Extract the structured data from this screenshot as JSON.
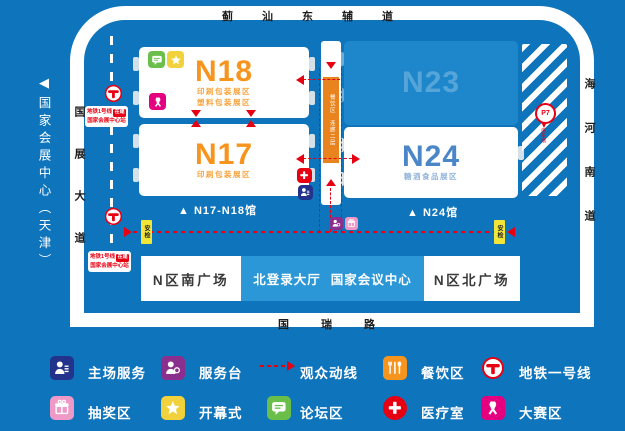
{
  "map": {
    "venue": {
      "arrow": "◀",
      "name": "国家会展中心（天津）"
    },
    "roads": {
      "top": "蓟汕东辅道",
      "left": "国展大道",
      "right": "海河南道",
      "bottom": "国瑞路"
    },
    "metro": {
      "line1": "地铁1号线",
      "badge": "在建",
      "line2": "国家会展中心站"
    },
    "halls": {
      "n18": {
        "name": "N18",
        "lines": [
          "印刷包装展区",
          "塑料包装展区"
        ]
      },
      "n17": {
        "name": "N17",
        "lines": [
          "印刷包装展区"
        ]
      },
      "n23": {
        "name": "N23"
      },
      "n24": {
        "name": "N24",
        "lines": [
          "糖酒食品展区"
        ]
      }
    },
    "gates": {
      "n17n18": "▲ N17-N18馆",
      "n24": "▲ N24馆"
    },
    "corridor": {
      "label_top": "餐饮区",
      "label_bottom": "连廊二层"
    },
    "security": "安检",
    "parking": {
      "label": "P7",
      "sub": "停车场"
    },
    "plazas": {
      "south": "N区南广场",
      "login_hall": "北登录大厅",
      "convention": "国家会议中心",
      "north": "N区北广场"
    }
  },
  "legend": {
    "items": [
      {
        "id": "host-service",
        "label": "主场服务",
        "color": "#23338b"
      },
      {
        "id": "service-desk",
        "label": "服务台",
        "color": "#8b2f8f"
      },
      {
        "id": "visitor-route",
        "label": "观众动线",
        "color": "#e60012"
      },
      {
        "id": "dining",
        "label": "餐饮区",
        "color": "#f7941d"
      },
      {
        "id": "metro-line-1",
        "label": "地铁一号线",
        "color": "#e60012"
      },
      {
        "id": "lottery",
        "label": "抽奖区",
        "color": "#ef9ac6"
      },
      {
        "id": "opening-ceremony",
        "label": "开幕式",
        "color": "#f2d23c"
      },
      {
        "id": "forum",
        "label": "论坛区",
        "color": "#6abf4a"
      },
      {
        "id": "medical",
        "label": "医疗室",
        "color": "#e60012"
      },
      {
        "id": "competition",
        "label": "大赛区",
        "color": "#e4007f"
      }
    ]
  },
  "colors": {
    "background": "#0e74bb",
    "road_white": "#ffffff",
    "hall_white": "#ffffff",
    "hall_accent_orange": "#f7941d",
    "n23_block_blue": "#1e87cc",
    "n24_text_blue": "#4a86c8",
    "route_red": "#e60012",
    "login_hall_blue": "#2b97d7",
    "corridor_orange": "#e8831d",
    "security_tag_yellow": "#f2e53a"
  }
}
